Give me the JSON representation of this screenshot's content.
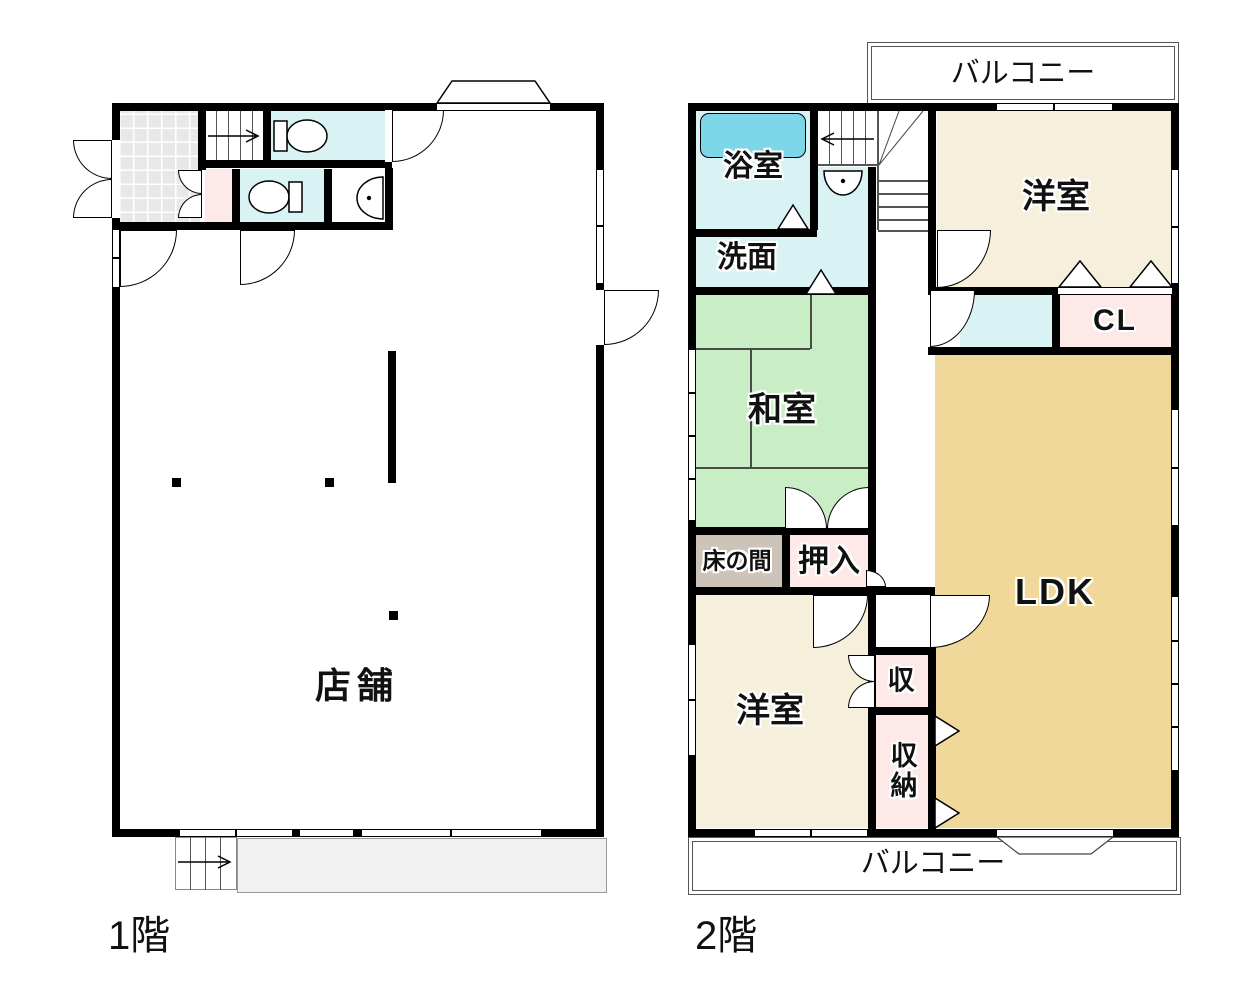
{
  "document_type": "floor-plan",
  "palette": {
    "wall": "#000000",
    "water_room_cyan": "#d9f3f5",
    "bathtub_cyan": "#7ed7e8",
    "tatami_green": "#c9eec6",
    "wood_cream": "#f6efdb",
    "ldk_tan": "#f0d89b",
    "closet_pink": "#fce9e8",
    "tokonoma_taupe": "#cec3b8",
    "tile_gray": "#e8e8e8",
    "porch_gray": "#f1f1f1"
  },
  "icons": [
    "toilet-icon",
    "sink-icon",
    "bathtub-icon",
    "stairs-icon",
    "stair-arrow-icon",
    "door-swing-arc-icon",
    "folding-door-triangle-icon",
    "window-icon",
    "pillar-icon",
    "entrance-canopy-icon",
    "balcony-step-icon"
  ],
  "floor1": {
    "label": "1階",
    "rooms": {
      "shop": "店舗"
    }
  },
  "floor2": {
    "label": "2階",
    "balcony_top": "バルコニー",
    "balcony_bottom": "バルコニー",
    "rooms": {
      "bath": "浴室",
      "washroom": "洗面",
      "japanese_room": "和室",
      "tokonoma": "床の間",
      "oshiire": "押入",
      "western_room_upper": "洋室",
      "closet_cl": "CL",
      "ldk": "LDK",
      "storage_small": "収",
      "storage": "収納",
      "western_room_lower": "洋室"
    }
  }
}
